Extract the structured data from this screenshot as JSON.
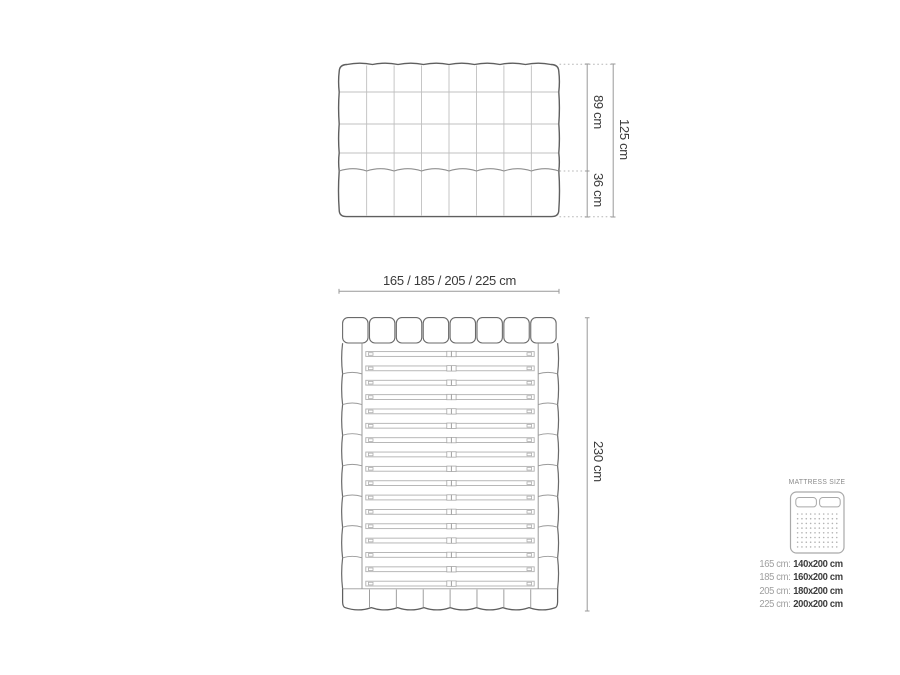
{
  "front_view": {
    "upper_height": "89 cm",
    "lower_height": "36 cm",
    "total_height": "125 cm"
  },
  "top_view": {
    "width_options": "165 / 185 / 205 / 225 cm",
    "length": "230 cm"
  },
  "legend": {
    "title": "MATTRESS SIZE",
    "rows": [
      {
        "bed_width": "165 cm:",
        "mattress": "140x200 cm"
      },
      {
        "bed_width": "185 cm:",
        "mattress": "160x200 cm"
      },
      {
        "bed_width": "205 cm:",
        "mattress": "180x200 cm"
      },
      {
        "bed_width": "225 cm:",
        "mattress": "200x200 cm"
      }
    ]
  },
  "colors": {
    "outline_dark": "#5f5f5f",
    "line_light": "#bfbfbf",
    "line_mid": "#9a9a9a",
    "dimension_line": "#999999",
    "text_dark": "#3a3a3a",
    "text_gray": "#9e9e9e",
    "background": "#ffffff"
  }
}
